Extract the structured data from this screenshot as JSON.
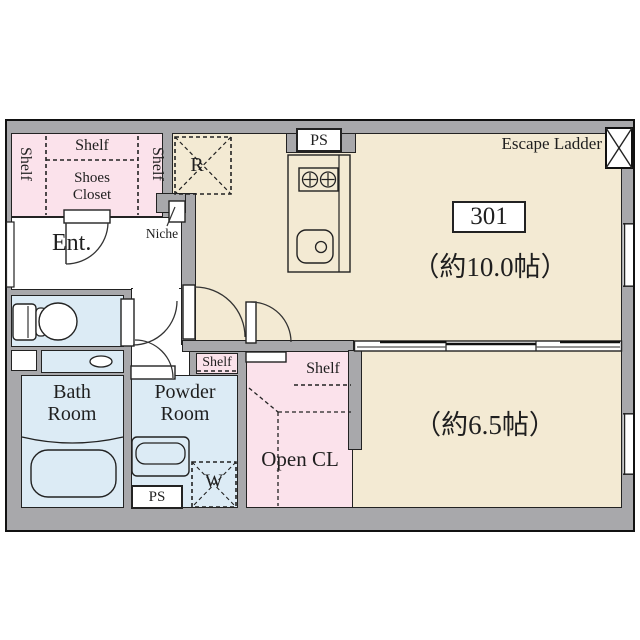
{
  "unit": {
    "number": "301"
  },
  "rooms": {
    "main": {
      "size": "（約10.0帖）"
    },
    "western": {
      "size": "（約6.5帖）"
    },
    "entrance": {
      "label": "Ent."
    },
    "bath": {
      "label": "Bath Room"
    },
    "powder": {
      "label": "Powder Room"
    },
    "open_closet": {
      "label": "Open CL"
    },
    "shoes_closet": {
      "label": "Shoes Closet"
    }
  },
  "features": {
    "escape_ladder": "Escape Ladder",
    "pipe_space_top": "PS",
    "pipe_space_bottom": "PS",
    "refrigerator_space": "R",
    "washer_space": "W",
    "niche": "Niche",
    "shelves": {
      "closet_top": "Shelf",
      "closet_left": "Shelf",
      "closet_right": "Shelf",
      "powder": "Shelf",
      "open_closet": "Shelf"
    }
  },
  "colors": {
    "wall": "#a8a8ab",
    "floor_beige": "#f3ead3",
    "closet_pink": "#fbe2eb",
    "wet_area_blue": "#dcebf5",
    "line": "#222222"
  }
}
